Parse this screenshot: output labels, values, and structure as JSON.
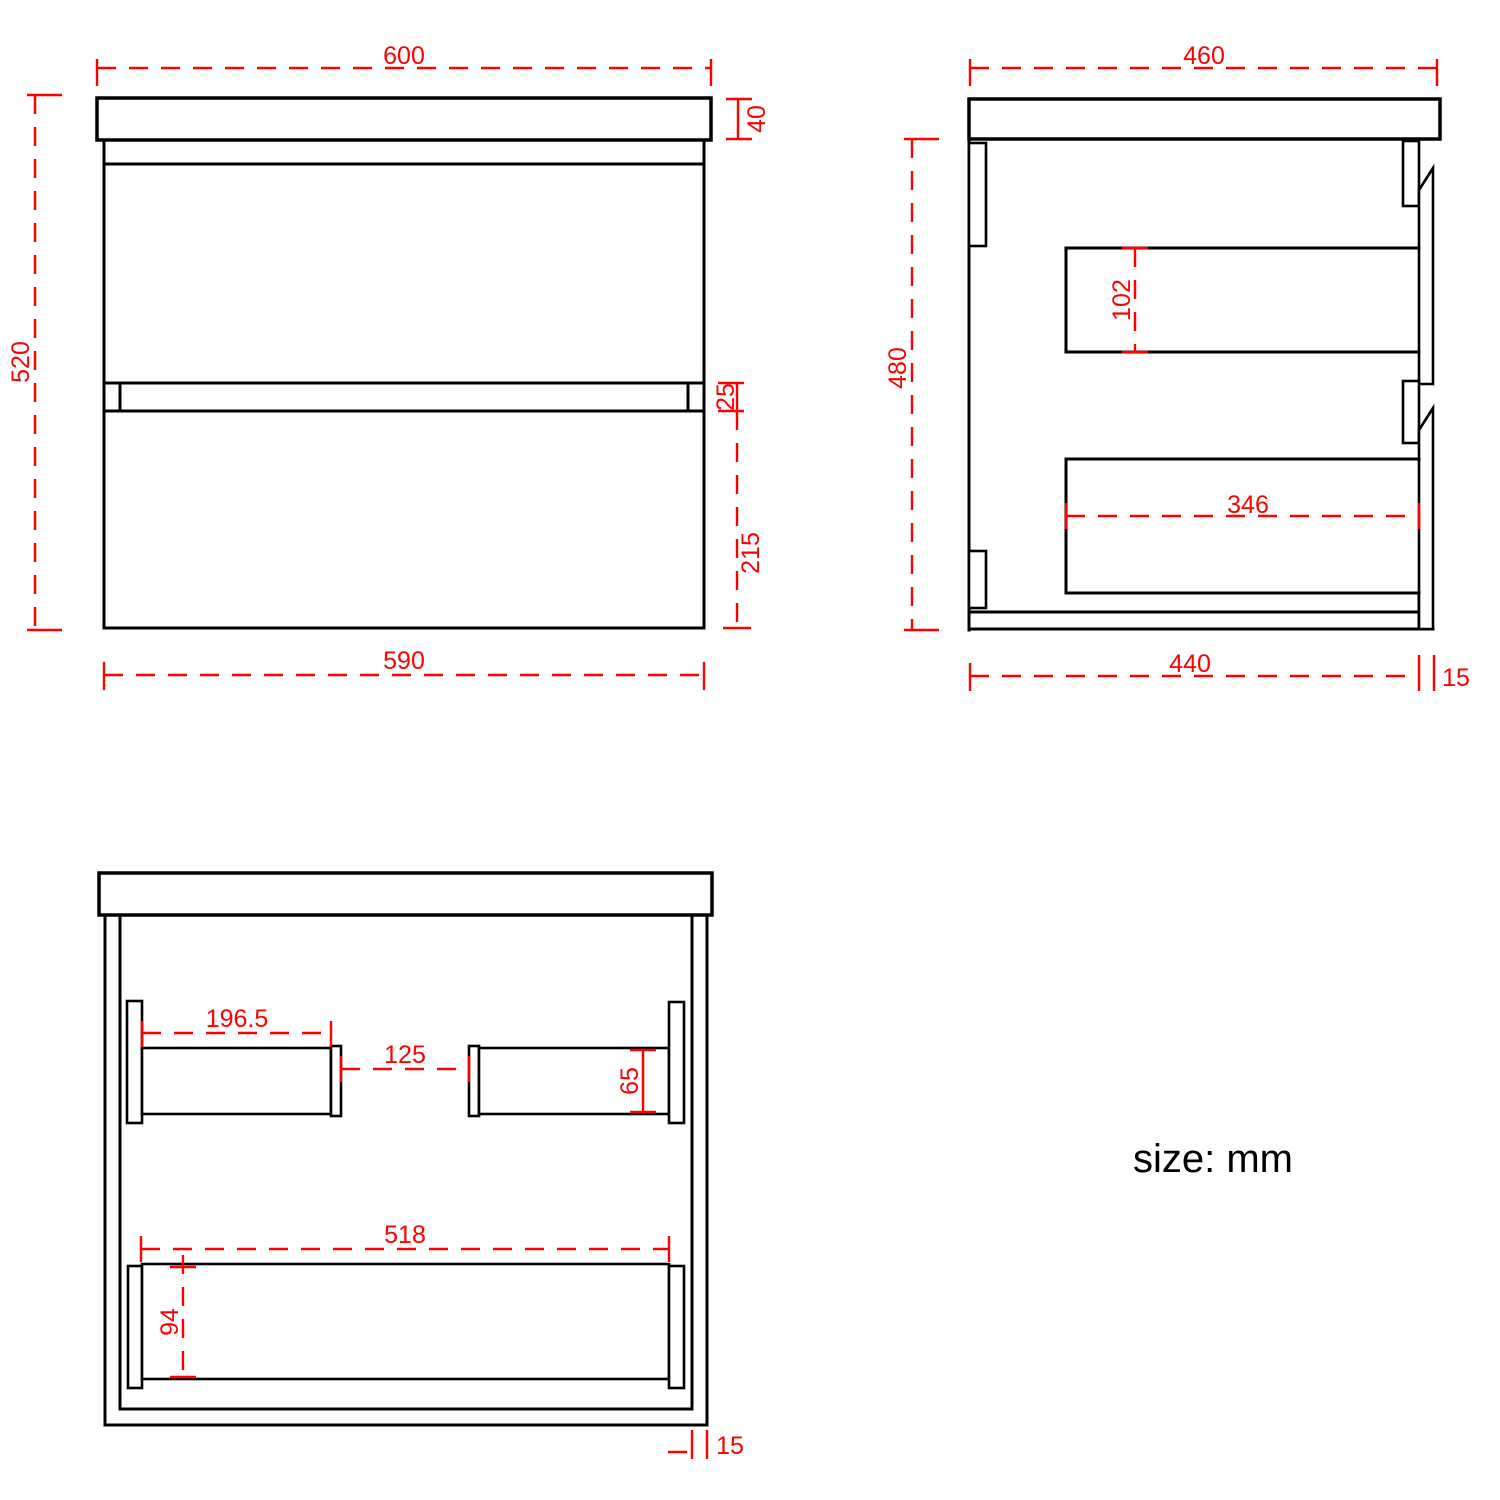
{
  "title_note": "size: mm",
  "colors": {
    "dimension_red": "#FF0000",
    "line_black": "#000000",
    "background": "#FFFFFF"
  },
  "front_view": {
    "label": "front view",
    "dims": {
      "overall_width": "600",
      "countertop_height": "40",
      "overall_height": "520",
      "drawer_gap": "25",
      "lower_drawer_height": "215",
      "cabinet_width": "590"
    }
  },
  "side_view": {
    "label": "side view",
    "dims": {
      "overall_depth": "460",
      "cabinet_height": "480",
      "upper_drawer_inner_height": "102",
      "lower_drawer_inner_depth": "346",
      "cabinet_depth": "440",
      "front_panel_thickness": "15"
    }
  },
  "open_view": {
    "label": "internal front view",
    "dims": {
      "left_rail_length": "196.5",
      "center_gap": "125",
      "rail_height": "65",
      "lower_rail_length": "518",
      "lower_rail_height": "94",
      "side_panel_thickness": "15"
    }
  }
}
